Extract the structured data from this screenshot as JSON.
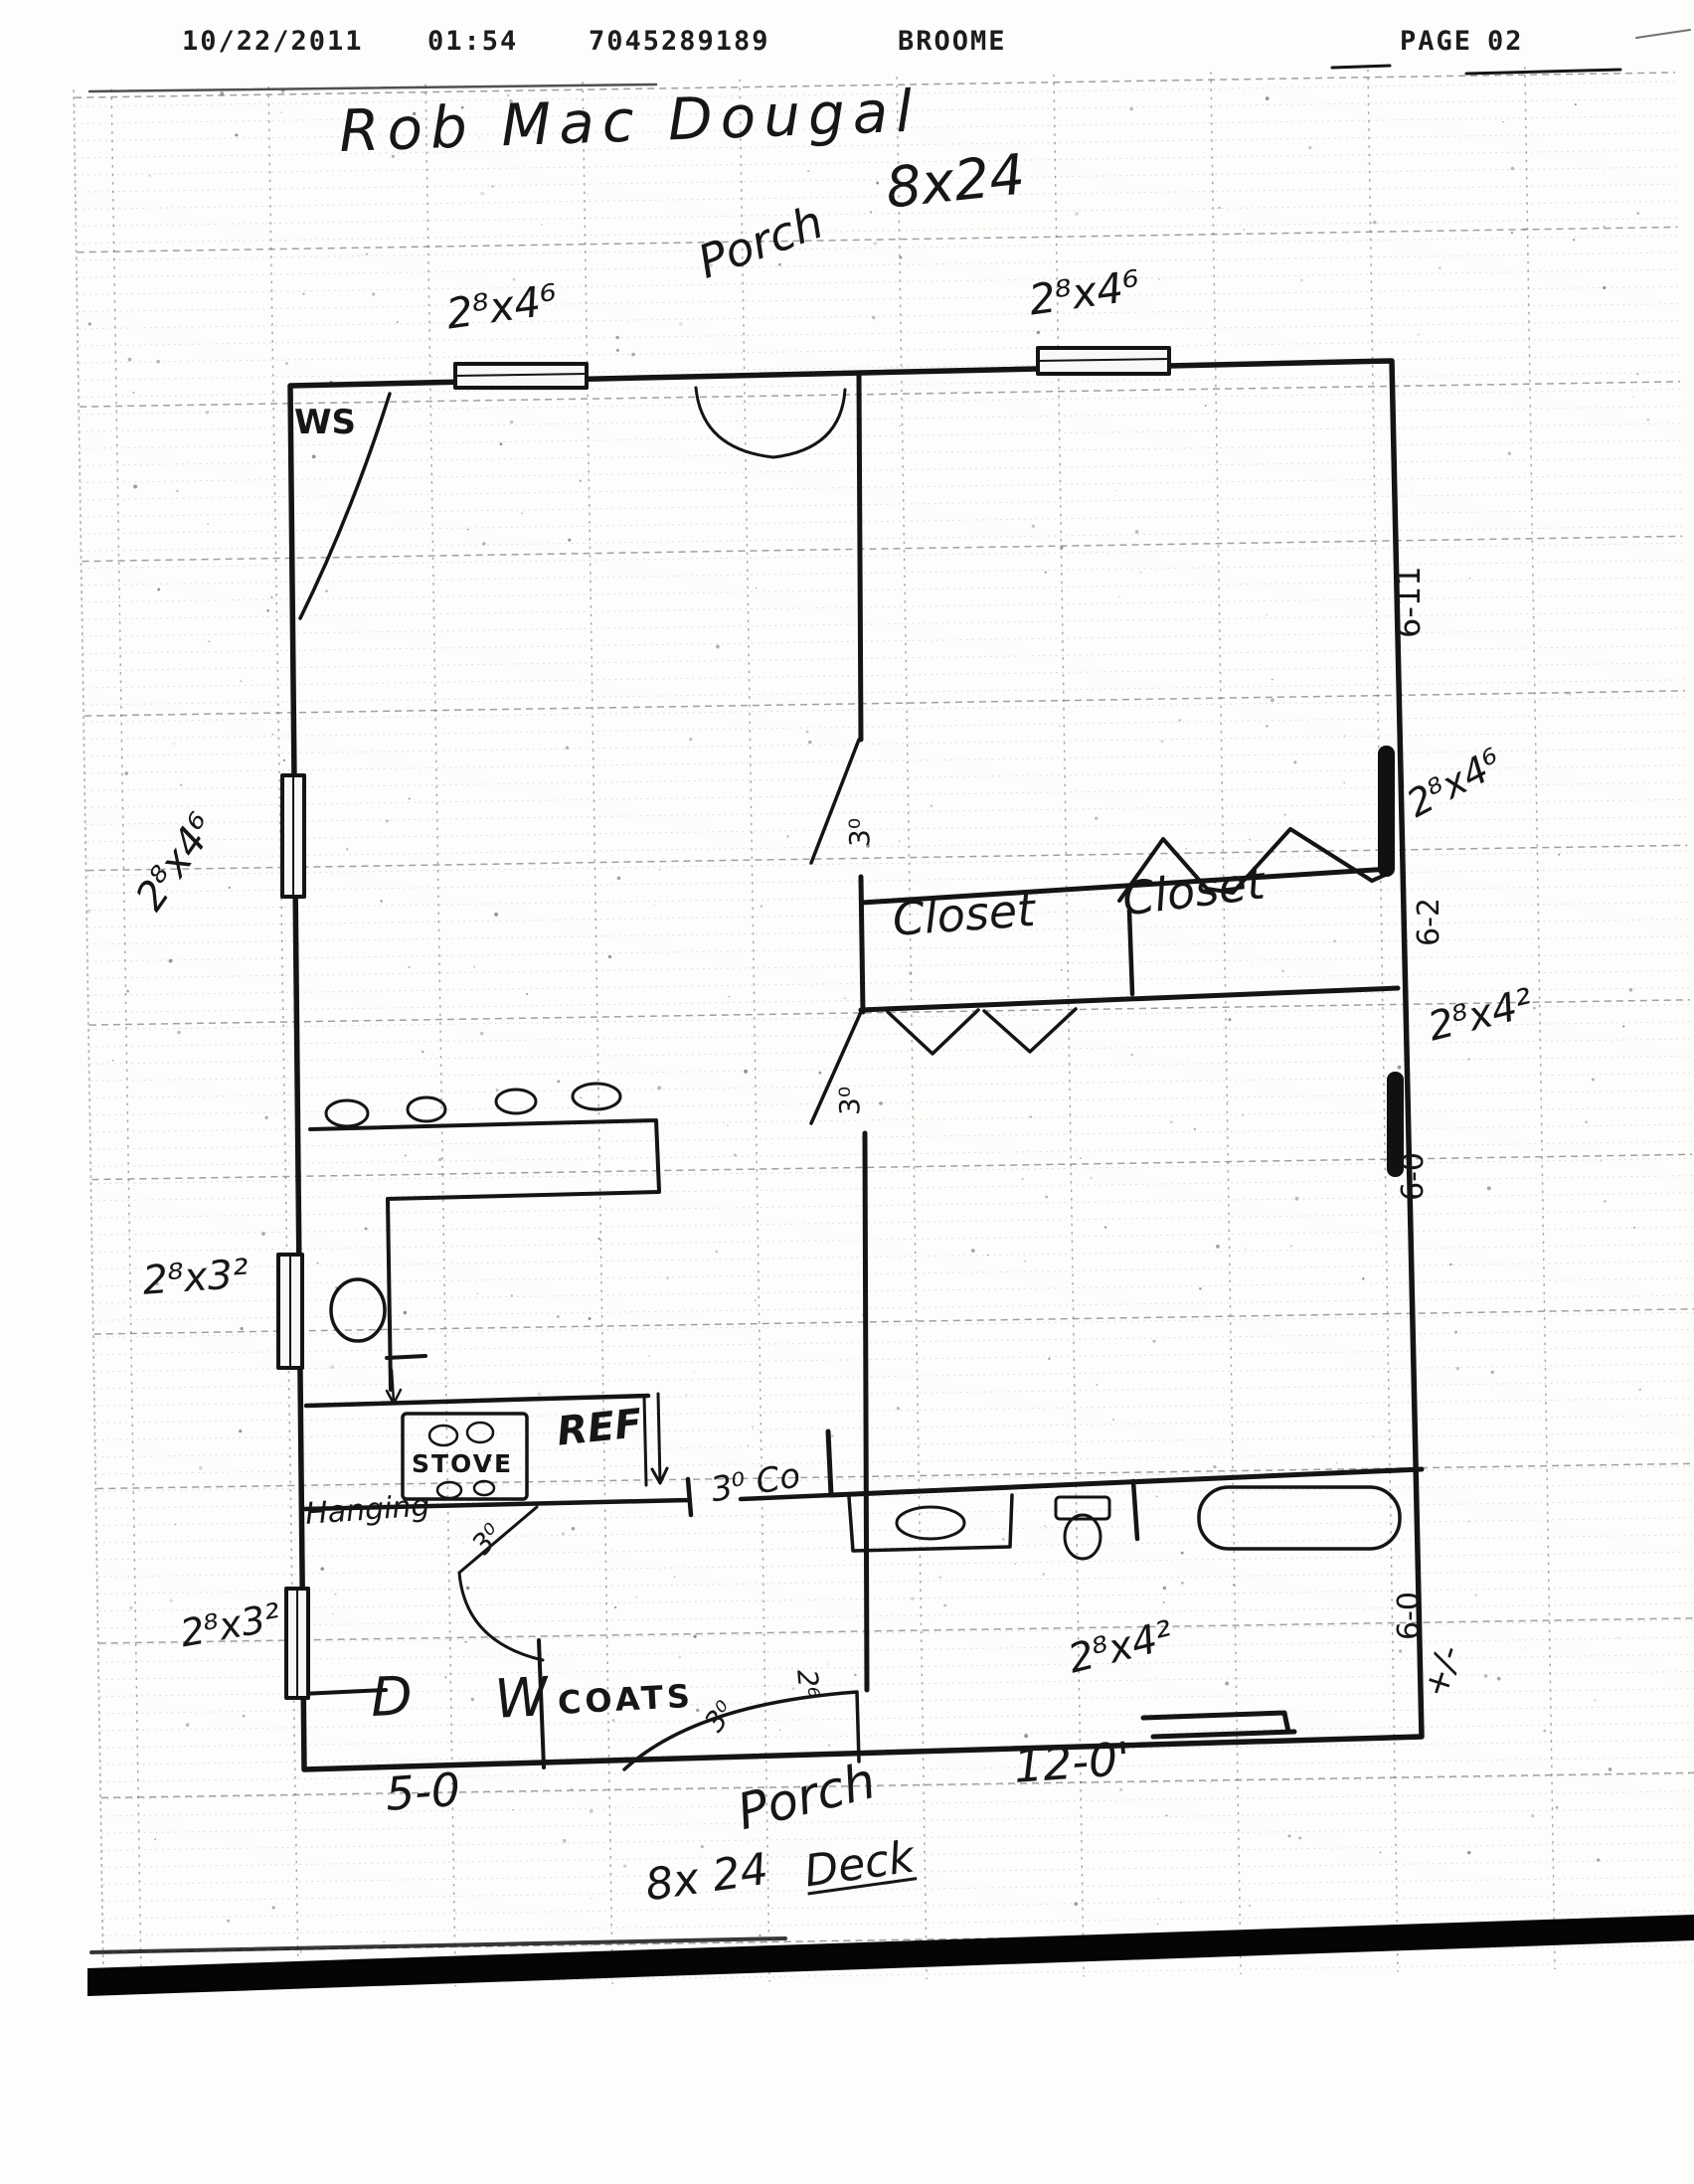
{
  "fax_header": {
    "date": "10/22/2011",
    "time": "01:54",
    "fax_number": "7045289189",
    "sender": "BROOME",
    "page_label": "PAGE",
    "page_number": "02"
  },
  "title": {
    "owner_name": "Rob Mac Dougal",
    "plan_dimension": "8x24"
  },
  "rooms": {
    "porch_top": "Porch",
    "porch_bottom": "Porch",
    "deck_size": "8x 24",
    "deck_word": "Deck",
    "closet_left": "Closet",
    "closet_right": "Closet",
    "coats": "COATS",
    "hanging": "Hanging",
    "wood_stove": "WS"
  },
  "fixtures": {
    "stove": "STOVE",
    "refrigerator": "REF",
    "dryer": "D",
    "washer": "W"
  },
  "windows": {
    "top_left": "2⁸x4⁶",
    "top_right": "2⁸x4⁶",
    "left_upper": "2⁸x4⁶",
    "left_mid": "2⁸x3²",
    "left_lower": "2⁸x3²",
    "right_upper": "2⁸x4⁶",
    "right_mid": "2⁸x4²",
    "bottom_right": "2⁸x4²"
  },
  "doors": {
    "cased_opening": "3⁰ Co",
    "door_kitchen": "3⁰",
    "door_hall_upper": "3⁰",
    "door_hall_lower": "3⁰",
    "door_entry": "3⁰",
    "door_bottom": "2⁶"
  },
  "dimensions": {
    "right_upper": "6-11",
    "right_mid": "6-2",
    "right_lower": "6-0",
    "right_bottom": "6-0",
    "tolerance": "+/-",
    "bottom_left": "5-0",
    "bottom_right": "12-0'"
  }
}
